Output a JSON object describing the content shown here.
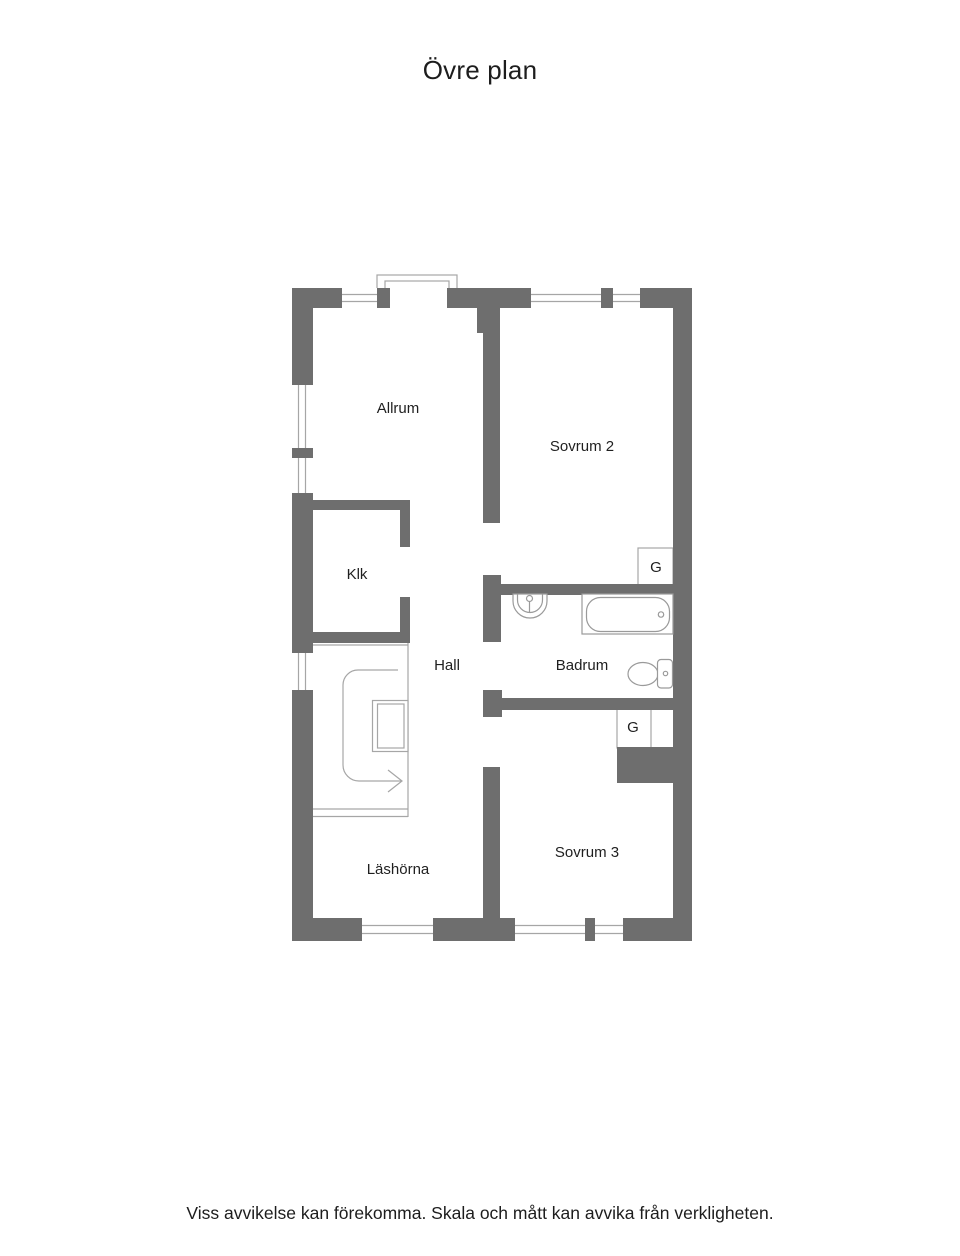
{
  "title": "Övre plan",
  "disclaimer": "Viss avvikelse kan förekomma. Skala och mått kan avvika från verkligheten.",
  "colors": {
    "wall": "#6e6e6e",
    "thin_line": "#a6a6a6",
    "fixture_line": "#9a9a9a",
    "text": "#1d1d1d",
    "background": "#ffffff"
  },
  "rooms": [
    {
      "name": "Allrum"
    },
    {
      "name": "Sovrum 2"
    },
    {
      "name": "Klk"
    },
    {
      "name": "Hall"
    },
    {
      "name": "Badrum"
    },
    {
      "name": "Sovrum 3"
    },
    {
      "name": "Läshörna"
    }
  ],
  "closets": [
    {
      "label": "G"
    },
    {
      "label": "G"
    }
  ],
  "fixtures": [
    "sink",
    "bathtub",
    "toilet",
    "staircase",
    "stair-direction-arrow",
    "chimney"
  ]
}
